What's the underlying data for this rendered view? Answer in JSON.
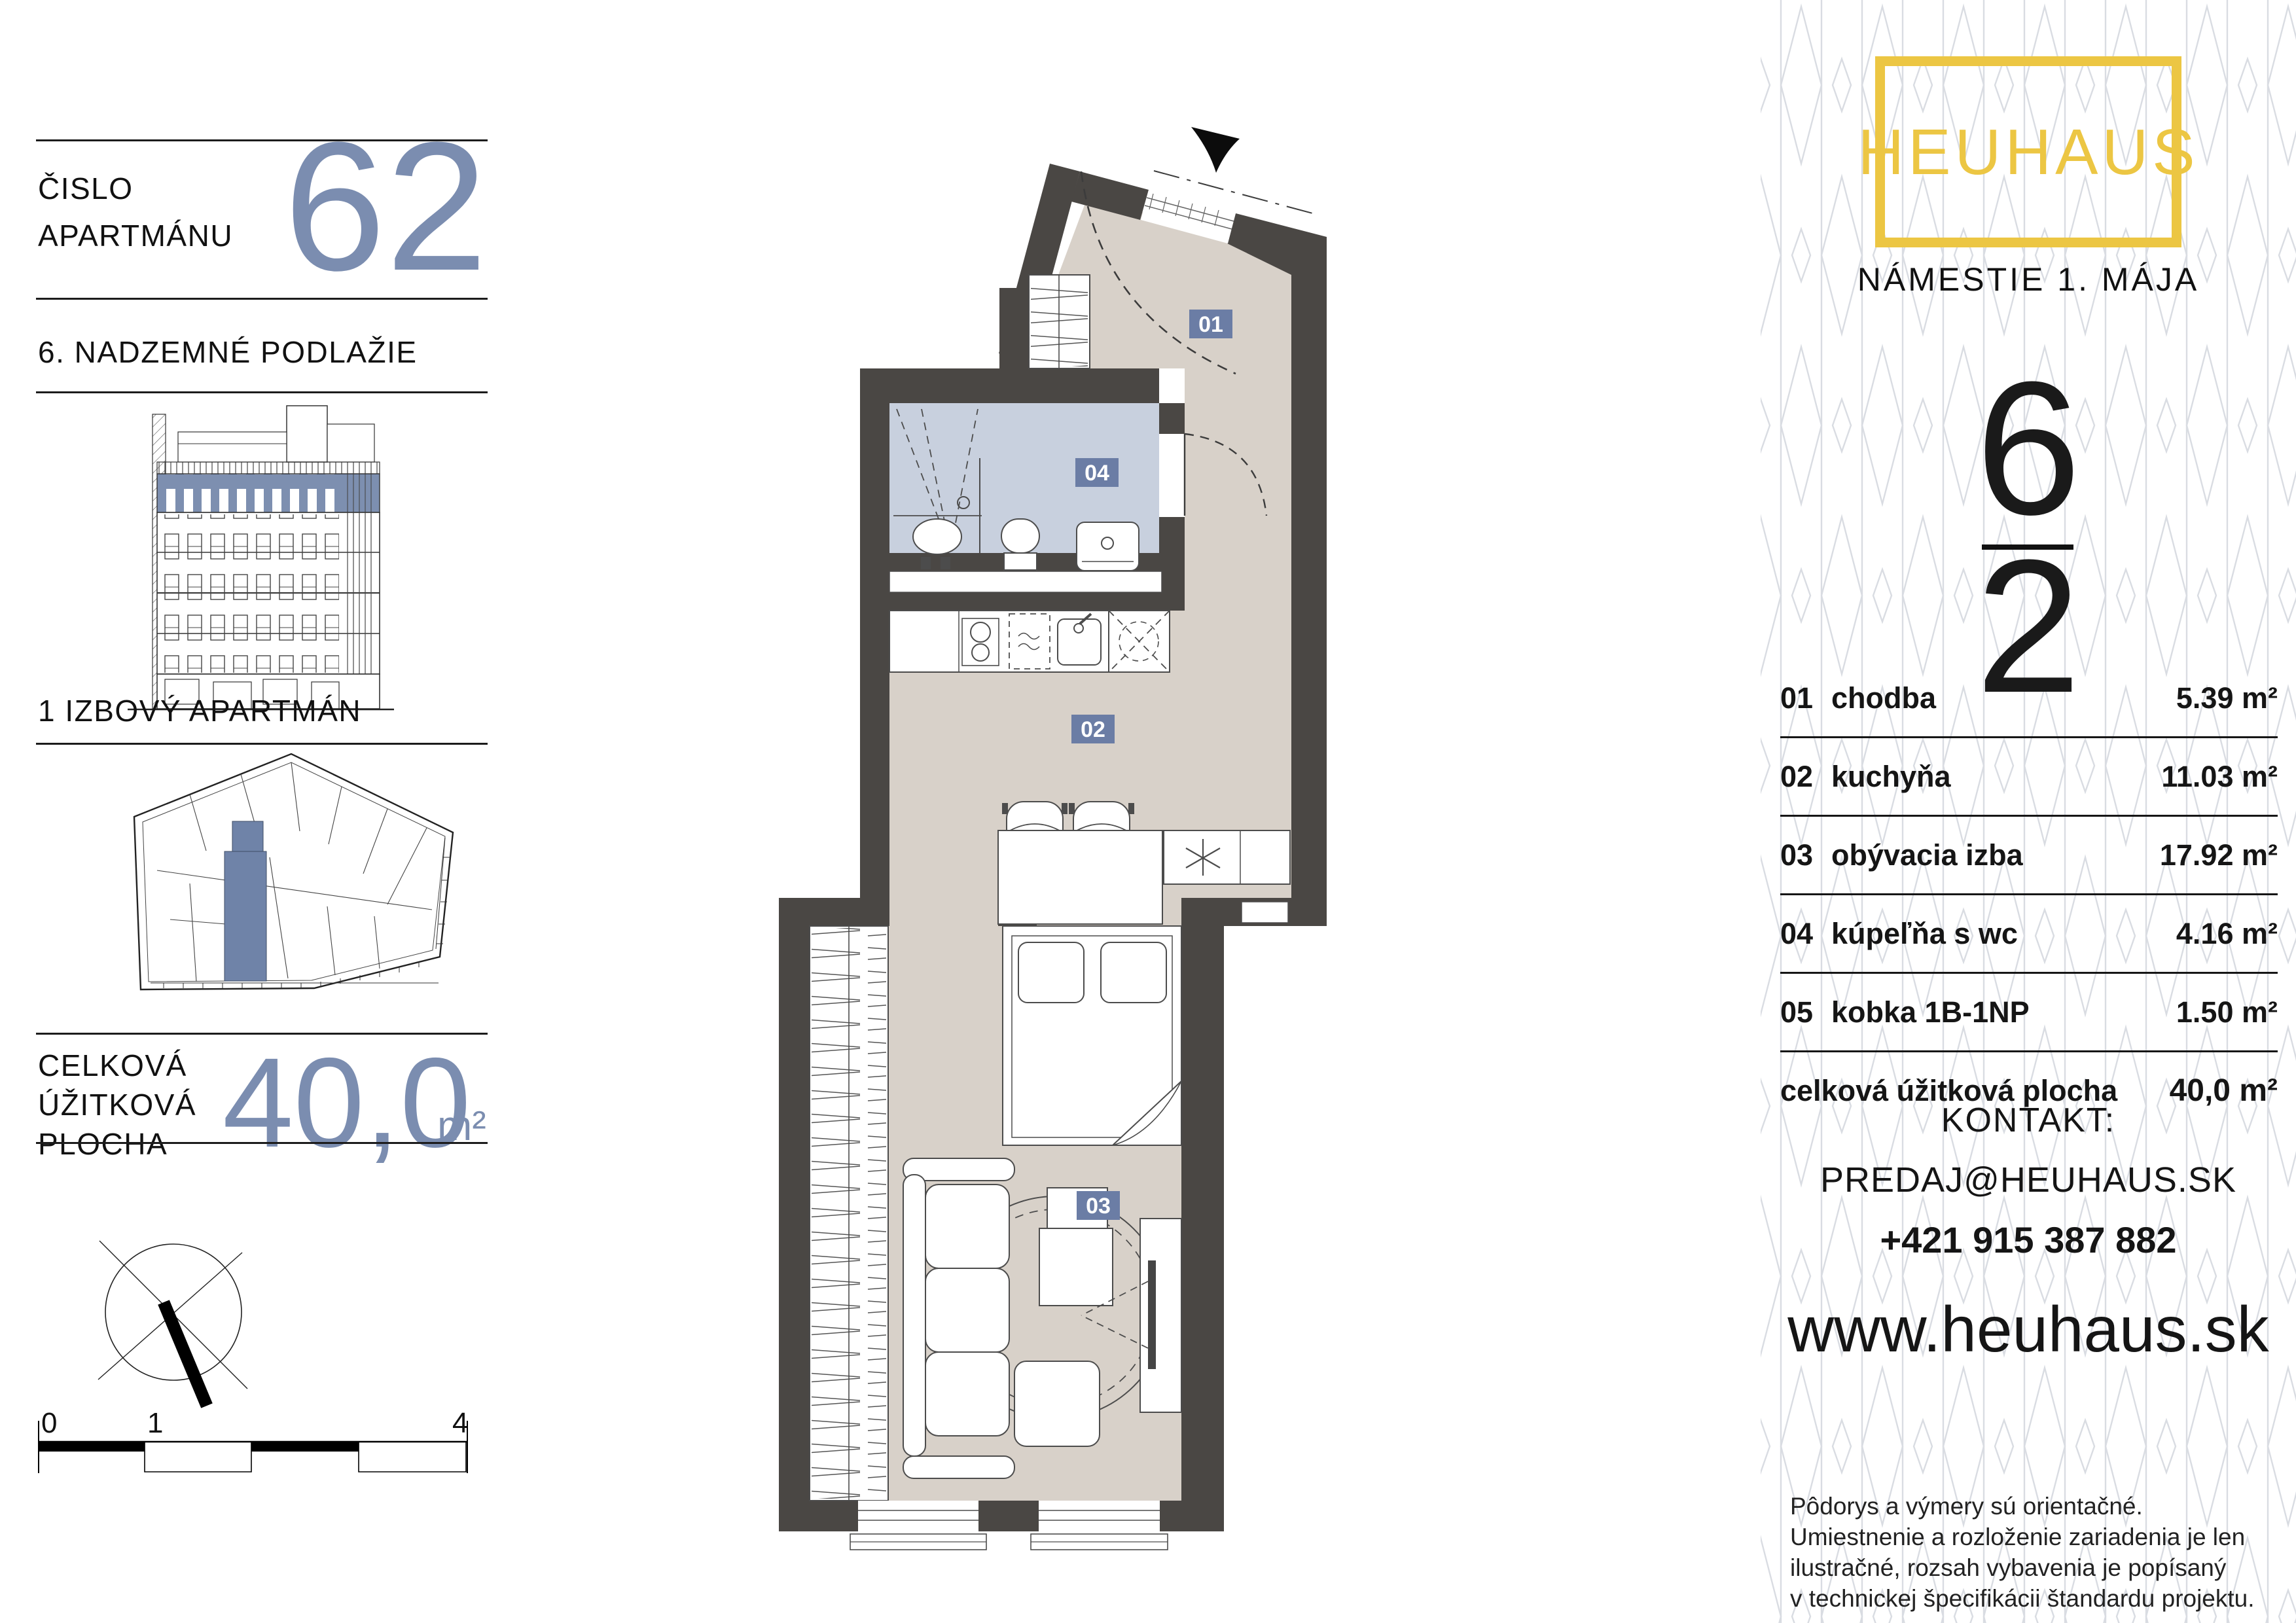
{
  "colors": {
    "accent_blue": "#7b8db0",
    "label_blue": "#6b7da5",
    "wall_dark": "#4a4744",
    "floor_beige": "#d8d1c9",
    "bath_blue": "#c8d0de",
    "brand_yellow": "#ecc643",
    "pattern_gray": "#d9dce2"
  },
  "left": {
    "apartment_label_line1": "ČISLO",
    "apartment_label_line2": "APARTMÁNU",
    "apartment_number": "62",
    "floor_title": "6. NADZEMNÉ PODLAŽIE",
    "type_title": "1 IZBOVÝ APARTMÁN",
    "area_label_line1": "CELKOVÁ",
    "area_label_line2": "ÚŽITKOVÁ",
    "area_label_line3": "PLOCHA",
    "area_value": "40,0",
    "area_unit": "m²",
    "scale": {
      "start": "0",
      "one": "1",
      "end": "4"
    }
  },
  "plan": {
    "labels": {
      "hall": "01",
      "kitchen": "02",
      "living": "03",
      "bath": "04"
    }
  },
  "right": {
    "brand": "HEUHAUS",
    "address": "NÁMESTIE 1. MÁJA",
    "floor_number": "6",
    "unit_number": "2",
    "table": {
      "rows": [
        {
          "no": "01",
          "name": "chodba",
          "area": "5.39 m²"
        },
        {
          "no": "02",
          "name": "kuchyňa",
          "area": "11.03 m²"
        },
        {
          "no": "03",
          "name": "obývacia izba",
          "area": "17.92 m²"
        },
        {
          "no": "04",
          "name": "kúpeľňa s wc",
          "area": "4.16 m²"
        },
        {
          "no": "05",
          "name": "kobka 1B-1NP",
          "area": "1.50 m²"
        }
      ],
      "total_label": "celková úžitková plocha",
      "total_value": "40,0 m²"
    },
    "contact": {
      "heading": "KONTAKT:",
      "email": "PREDAJ@HEUHAUS.SK",
      "phone": "+421 915 387 882"
    },
    "website": "www.heuhaus.sk",
    "disclaimer": [
      "Pôdorys a výmery sú orientačné.",
      "Umiestnenie a rozloženie zariadenia je len",
      "ilustračné, rozsah vybavenia je popísaný",
      "v technickej špecifikácii štandardu projektu."
    ]
  }
}
